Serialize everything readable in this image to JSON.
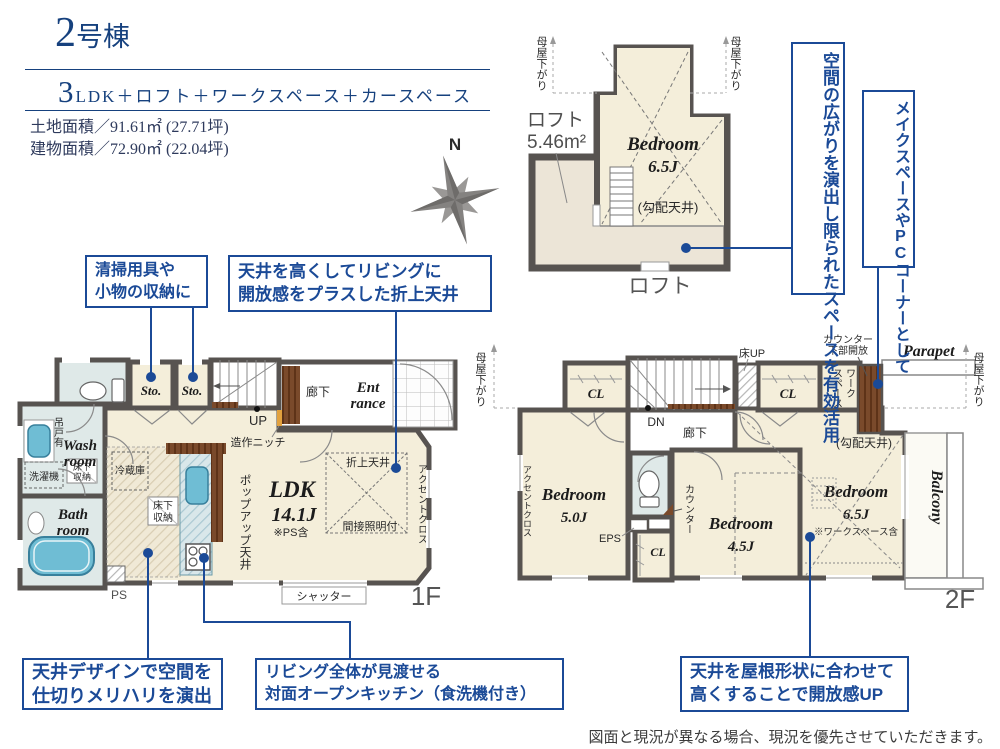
{
  "header": {
    "no": "2",
    "no_suffix": "号棟",
    "plan_big": "3",
    "plan_rest": "LDK＋ロフト＋ワークスペース＋カースペース",
    "land": "土地面積／91.61㎡ (27.71坪)",
    "building": "建物面積／72.90㎡ (22.04坪)"
  },
  "compass": {
    "n": "N"
  },
  "loft": {
    "label1": "ロフト",
    "label2": "5.46m²",
    "room": "Bedroom",
    "size": "6.5J",
    "ceil": "(勾配天井)",
    "caption": "ロフト",
    "eaves": "母屋下がり"
  },
  "f1": {
    "caption": "1F",
    "sto": "Sto.",
    "hall": "廊下",
    "ent1": "Ent",
    "ent2": "rance",
    "up": "UP",
    "niche": "造作ニッチ",
    "hang": "吊戸有",
    "wash1": "Wash",
    "wash2": "room",
    "washer": "洗濯機",
    "under1": "床下",
    "under2": "収納",
    "bath1": "Bath",
    "bath2": "room",
    "ps": "PS",
    "fridge": "冷蔵庫",
    "ldk": "LDK",
    "ldk_size": "14.1J",
    "ldk_note": "※PS含",
    "popup": "ポップアップ天井",
    "coffered": "折上天井",
    "indirect": "間接照明付",
    "accent": "アクセントクロス",
    "shutter": "シャッター"
  },
  "f2": {
    "caption": "2F",
    "cl": "CL",
    "dn": "DN",
    "hall": "廊下",
    "floor_up": "床UP",
    "co1": "カウンター",
    "co2": "下部開放",
    "ws1": "ワーク",
    "ws2": "スペース",
    "parapet": "Parapet",
    "slope": "(勾配天井)",
    "accent": "アクセントクロス",
    "bed": "Bedroom",
    "s5": "5.0J",
    "s45": "4.5J",
    "s65": "6.5J",
    "b65_note": "※ワークスペース含",
    "eps": "EPS",
    "counter": "カウンター",
    "balcony": "Balcony",
    "eaves": "母屋下がり"
  },
  "callouts": {
    "storage": {
      "l1": "清掃用具や",
      "l2": "小物の収納に"
    },
    "coffered": {
      "l1": "天井を高くしてリビングに",
      "l2": "開放感をプラスした折上天井"
    },
    "loft": {
      "l1": "空間の広がりを演出し",
      "l2": "限られたスペースを有効活用"
    },
    "pc": {
      "l1": "メイクスペースや",
      "l2": "PCコーナーとして"
    },
    "ceiling": {
      "l1": "天井デザインで空間を",
      "l2": "仕切りメリハリを演出"
    },
    "kitchen": {
      "l1": "リビング全体が見渡せる",
      "l2": "対面オープンキッチン（食洗機付き）"
    },
    "roof": {
      "l1": "天井を屋根形状に合わせて",
      "l2": "高くすることで開放感UP"
    }
  },
  "footer": {
    "disclaimer": "図面と現況が異なる場合、現況を優先させていただきます。"
  },
  "colors": {
    "accent_blue": "#1b4a97",
    "header_blue": "#16417e",
    "wall": "#575350",
    "floor_cream": "#f4eeda",
    "water_blue": "#dfe9e8",
    "fixture_blue": "#6fbdd4",
    "wood_brown": "#7a4a2b"
  }
}
